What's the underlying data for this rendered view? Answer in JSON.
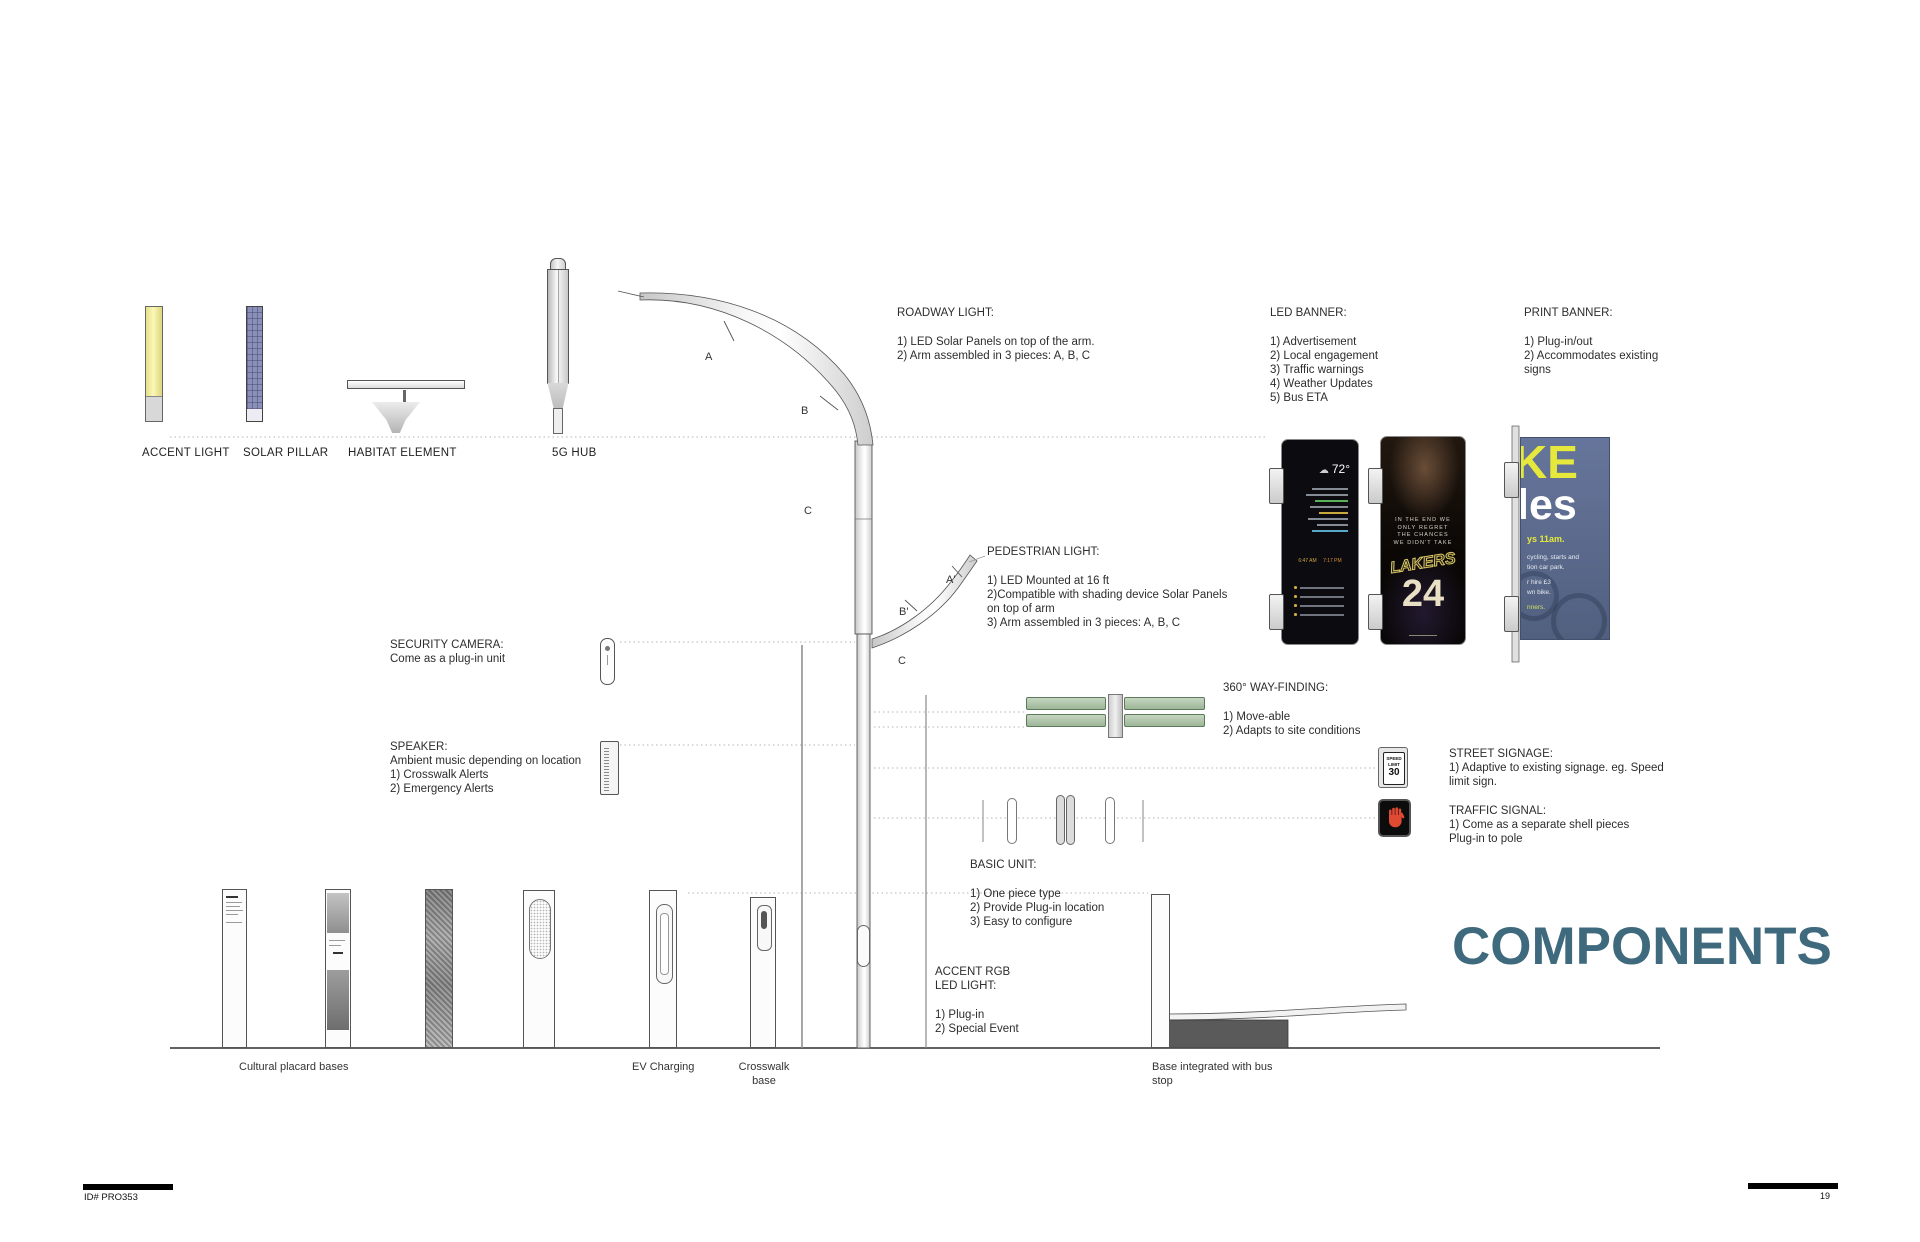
{
  "page": {
    "title": "COMPONENTS",
    "footer_id": "ID# PRO353",
    "page_number": "19"
  },
  "colors": {
    "title": "#3f6a7e",
    "wayfinding_green": "#b7cdb4",
    "traffic_hand": "#e04a33",
    "poster_blue": "#5d6c8b",
    "poster_yellow": "#e6e93c",
    "accent_light_yellow": "#f4eea0",
    "solar_pillar_blue": "#8b90bb"
  },
  "top_components": {
    "labels": [
      "ACCENT LIGHT",
      "SOLAR PILLAR",
      "HABITAT ELEMENT",
      "5G HUB"
    ]
  },
  "segments": {
    "arm_a": "A",
    "arm_b": "B",
    "arm_c": "C",
    "ped_a": "A'",
    "ped_b": "B'",
    "ped_c": "C"
  },
  "annotations": {
    "roadway_light": {
      "heading": "ROADWAY LIGHT:",
      "lines": [
        "1) LED Solar Panels on top of the arm.",
        "2) Arm assembled in 3  pieces: A, B, C"
      ]
    },
    "led_banner": {
      "heading": "LED BANNER:",
      "lines": [
        "1) Advertisement",
        "2) Local engagement",
        "3) Traffic warnings",
        "4) Weather Updates",
        "5) Bus ETA"
      ]
    },
    "print_banner": {
      "heading": "PRINT BANNER:",
      "lines": [
        "1) Plug-in/out",
        "2) Accommodates existing",
        "signs"
      ]
    },
    "pedestrian_light": {
      "heading": "PEDESTRIAN LIGHT:",
      "lines": [
        "1) LED Mounted at 16 ft",
        "2)Compatible with  shading device  Solar Panels",
        "on top  of arm",
        "3) Arm assembled in 3  pieces: A, B, C"
      ]
    },
    "security_camera": {
      "heading": "SECURITY CAMERA:",
      "lines": [
        "Come as a plug-in unit"
      ]
    },
    "speaker": {
      "heading": "SPEAKER:",
      "lines": [
        "Ambient music depending  on location",
        "1) Crosswalk Alerts",
        "2) Emergency Alerts"
      ]
    },
    "wayfinding": {
      "heading": "360° WAY-FINDING:",
      "lines": [
        "1) Move-able",
        "2) Adapts to site conditions"
      ]
    },
    "street_signage": {
      "heading": "STREET SIGNAGE:",
      "lines": [
        "1) Adaptive to existing signage. eg. Speed",
        "limit sign."
      ]
    },
    "traffic_signal": {
      "heading": "TRAFFIC SIGNAL:",
      "lines": [
        "1) Come as a separate  shell pieces",
        "Plug-in to pole"
      ]
    },
    "basic_unit": {
      "heading": "BASIC UNIT:",
      "lines": [
        "1) One piece type",
        "2) Provide Plug-in location",
        "3) Easy to configure"
      ]
    },
    "accent_rgb": {
      "heading_1": "ACCENT RGB",
      "heading_2": "LED LIGHT:",
      "lines": [
        "1) Plug-in",
        "2) Special Event"
      ]
    }
  },
  "icons": {
    "street_sign": {
      "line1": "SPEED",
      "line2": "LIMIT",
      "value": "30"
    }
  },
  "screens": {
    "led_weather": {
      "temp": "72°",
      "cloud_icon": "☁",
      "sunrise": "6:47 AM",
      "sunset": "7:17 PM"
    },
    "led_sports": {
      "quote_lines": [
        "IN THE END WE",
        "ONLY REGRET",
        "THE CHANCES",
        "WE DIDN'T TAKE"
      ],
      "team": "LAKERS",
      "number": "24"
    },
    "print_poster": {
      "word_top": "KE",
      "word_bottom": "les",
      "tagline": "ys 11am.",
      "lines": [
        "cycling, starts and",
        "tion car park.",
        "r hire £3",
        "wn bike.",
        "nners."
      ]
    }
  },
  "base_labels": {
    "cultural": "Cultural placard bases",
    "ev": "EV Charging",
    "crosswalk": "Crosswalk base",
    "bus": "Base integrated with bus stop"
  }
}
